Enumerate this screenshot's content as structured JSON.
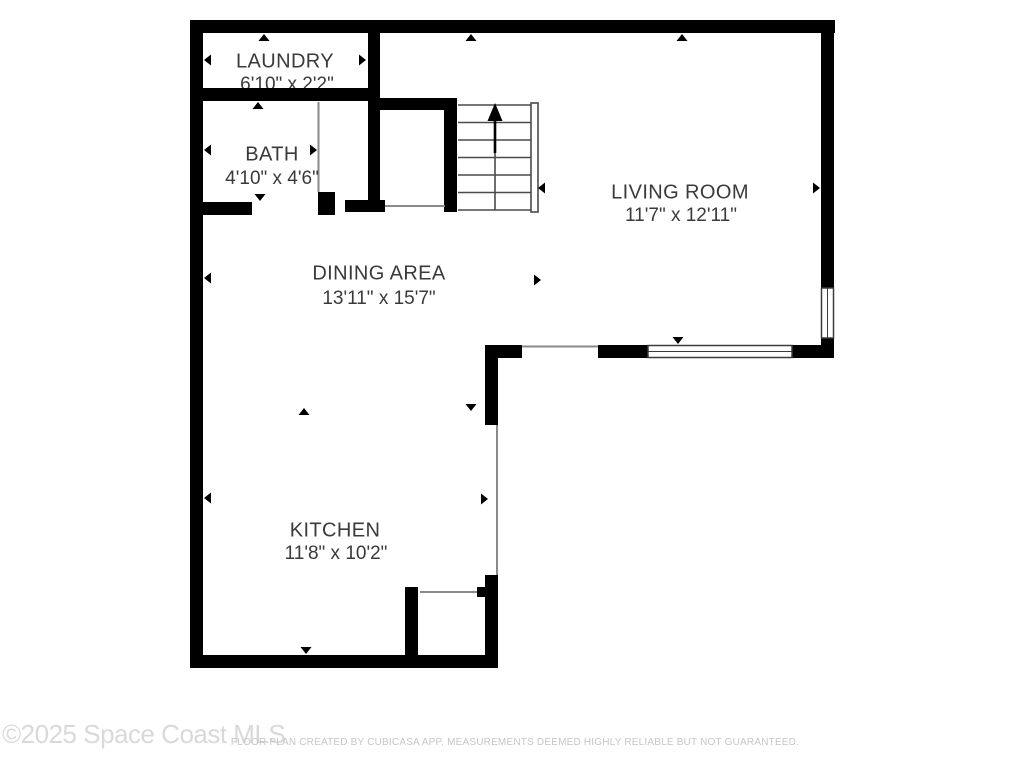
{
  "floor_plan": {
    "rooms": [
      {
        "id": "laundry",
        "name": "LAUNDRY",
        "dimensions": "6'10\" x 2'2\""
      },
      {
        "id": "bath",
        "name": "BATH",
        "dimensions": "4'10\" x 4'6\""
      },
      {
        "id": "living_room",
        "name": "LIVING ROOM",
        "dimensions": "11'7\" x 12'11\""
      },
      {
        "id": "dining_area",
        "name": "DINING AREA",
        "dimensions": "13'11\" x 15'7\""
      },
      {
        "id": "kitchen",
        "name": "KITCHEN",
        "dimensions": "11'8\" x 10'2\""
      }
    ],
    "icons": {
      "stairs_direction": "up-arrow",
      "measurement_markers": "small-black-triangles"
    }
  },
  "watermark": "©2025 Space Coast MLS",
  "footer_disclaimer": "FLOOR PLAN CREATED BY CUBICASA APP. MEASUREMENTS DEEMED HIGHLY RELIABLE BUT NOT GUARANTEED.",
  "colors": {
    "wall": "#000000",
    "window_frame": "#3c3c3c",
    "opening": "#8a8a8a",
    "stair": "#4a4a4a",
    "label": "#3a3a3a",
    "watermark": "#d9d9d9",
    "footer": "#c6c6c6",
    "background": "#ffffff"
  }
}
